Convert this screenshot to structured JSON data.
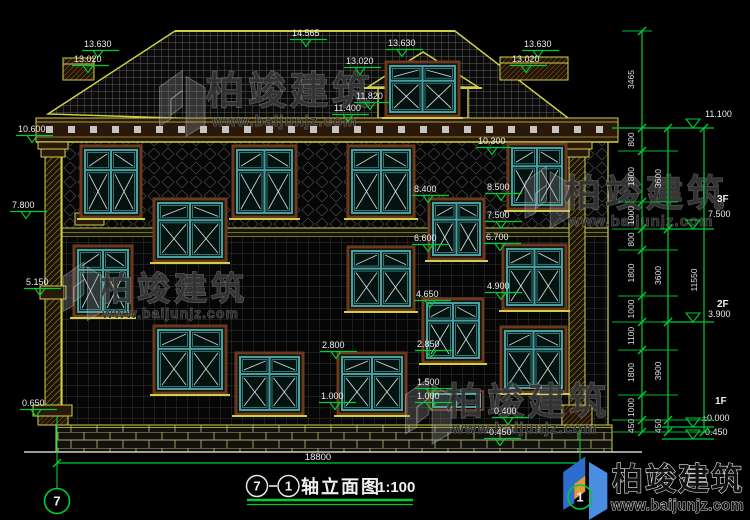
{
  "drawing": {
    "colors": {
      "background": "#000000",
      "cad_yellow": "#cfcf4a",
      "cad_green": "#00cc33",
      "window_teal": "#49a0a0",
      "window_teal_dark": "#2f7878",
      "trim_brown": "#6b3a1e",
      "band_brown": "#2a180a",
      "text_white": "#e8e8e8",
      "brand_blue": "#2e6cd0",
      "brand_blue2": "#4b8de2",
      "brand_orange": "#e09a3a"
    },
    "title": {
      "axis_start": "7",
      "axis_end": "1",
      "name": "轴立面图",
      "scale": "1:100"
    },
    "overall_width_dim": "18800",
    "axis_bubbles": [
      {
        "label": "7"
      },
      {
        "label": "1"
      }
    ],
    "brand": {
      "text": "柏竣建筑",
      "url": "www.baijunjz.com"
    },
    "watermarks": [
      {
        "text": "柏竣建筑",
        "url": "www.baijunjz.com",
        "icon_x": 150,
        "icon_y": 64,
        "icon_s": 0.95,
        "tx": 206,
        "ty": 104,
        "ts": 38,
        "ux": 212,
        "uy": 126,
        "us": 15
      },
      {
        "text": "柏竣建筑",
        "url": "www.baijunjz.com",
        "icon_x": 55,
        "icon_y": 256,
        "icon_s": 0.85,
        "tx": 100,
        "ty": 300,
        "ts": 33,
        "ux": 102,
        "uy": 318,
        "us": 14
      },
      {
        "text": "柏竣建筑",
        "url": "www.baijunjz.com",
        "icon_x": 516,
        "icon_y": 160,
        "icon_s": 0.9,
        "tx": 564,
        "ty": 206,
        "ts": 37,
        "ux": 568,
        "uy": 226,
        "us": 15
      },
      {
        "text": "柏竣建筑",
        "url": "www.baijunjz.com",
        "icon_x": 396,
        "icon_y": 372,
        "icon_s": 0.95,
        "tx": 446,
        "ty": 414,
        "ts": 37,
        "ux": 452,
        "uy": 433,
        "us": 15
      }
    ],
    "elevation_labels": [
      {
        "text": "13.630",
        "x": 84,
        "y": 39
      },
      {
        "text": "13.020",
        "x": 74,
        "y": 54
      },
      {
        "text": "14.565",
        "x": 292,
        "y": 28
      },
      {
        "text": "13.630",
        "x": 388,
        "y": 38
      },
      {
        "text": "13.020",
        "x": 346,
        "y": 56
      },
      {
        "text": "11.820",
        "x": 356,
        "y": 91
      },
      {
        "text": "11.400",
        "x": 334,
        "y": 103
      },
      {
        "text": "13.630",
        "x": 524,
        "y": 39
      },
      {
        "text": "13.020",
        "x": 512,
        "y": 54
      },
      {
        "text": "10.600",
        "x": 18,
        "y": 124
      },
      {
        "text": "10.300",
        "x": 478,
        "y": 136
      },
      {
        "text": "7.800",
        "x": 12,
        "y": 200
      },
      {
        "text": "5.150",
        "x": 26,
        "y": 277
      },
      {
        "text": "0.650",
        "x": 22,
        "y": 398
      },
      {
        "text": "8.400",
        "x": 414,
        "y": 184
      },
      {
        "text": "8.500",
        "x": 487,
        "y": 182
      },
      {
        "text": "7.500",
        "x": 487,
        "y": 210
      },
      {
        "text": "6.600",
        "x": 414,
        "y": 233
      },
      {
        "text": "6.700",
        "x": 486,
        "y": 232
      },
      {
        "text": "4.650",
        "x": 416,
        "y": 289
      },
      {
        "text": "4.900",
        "x": 487,
        "y": 281
      },
      {
        "text": "2.800",
        "x": 322,
        "y": 340
      },
      {
        "text": "2.850",
        "x": 417,
        "y": 339
      },
      {
        "text": "1.000",
        "x": 321,
        "y": 391
      },
      {
        "text": "1.500",
        "x": 417,
        "y": 377
      },
      {
        "text": "1.000",
        "x": 417,
        "y": 391
      },
      {
        "text": "0.400",
        "x": 494,
        "y": 406
      },
      {
        "text": "-0.450",
        "x": 486,
        "y": 427
      }
    ],
    "right_markers": [
      {
        "floor": "",
        "elev": "11.100",
        "fx": 0,
        "fy": 0,
        "ex": 705,
        "ey": 117,
        "line_y": 128,
        "x1": 612,
        "x2": 714
      },
      {
        "floor": "3F",
        "elev": "7.500",
        "fx": 717,
        "fy": 202,
        "ex": 708,
        "ey": 217,
        "line_y": 229,
        "x1": 662,
        "x2": 714
      },
      {
        "floor": "2F",
        "elev": "3.900",
        "fx": 717,
        "fy": 307,
        "ex": 708,
        "ey": 317,
        "line_y": 322,
        "x1": 662,
        "x2": 714
      },
      {
        "floor": "1F",
        "elev": "±0.000",
        "fx": 715,
        "fy": 404,
        "ex": 702,
        "ey": 421,
        "line_y": 427,
        "x1": 662,
        "x2": 714
      },
      {
        "floor": "",
        "elev": "-0.450",
        "fx": 0,
        "fy": 0,
        "ex": 702,
        "ey": 435,
        "line_y": 439,
        "x1": 662,
        "x2": 714
      }
    ],
    "dim_chains": [
      {
        "x": 642,
        "text_x": 634,
        "boundaries": [
          31,
          128,
          151,
          202,
          229,
          250,
          296,
          322,
          350,
          395,
          420,
          432
        ],
        "labels": [
          "3465",
          "800",
          "1800",
          "1000",
          "800",
          "1800",
          "1000",
          "1100",
          "1800",
          "1000",
          "450"
        ]
      },
      {
        "x": 668,
        "text_x": 661,
        "boundaries": [
          128,
          229,
          322,
          420,
          432
        ],
        "labels": [
          "3600",
          "3600",
          "3900",
          "450"
        ]
      },
      {
        "x": 704,
        "text_x": 697,
        "boundaries": [
          128,
          432
        ],
        "labels": [
          "11550"
        ]
      }
    ],
    "witness_lines": [
      [
        622,
        31,
        652
      ],
      [
        612,
        128,
        714
      ],
      [
        618,
        151,
        678
      ],
      [
        618,
        202,
        678
      ],
      [
        612,
        229,
        678
      ],
      [
        618,
        250,
        678
      ],
      [
        618,
        296,
        678
      ],
      [
        612,
        322,
        678
      ],
      [
        618,
        350,
        678
      ],
      [
        618,
        395,
        678
      ],
      [
        612,
        420,
        714
      ],
      [
        612,
        432,
        714
      ]
    ],
    "windows": [
      [
        390,
        66,
        65,
        46,
        "std"
      ],
      [
        85,
        150,
        52,
        63,
        "std"
      ],
      [
        237,
        150,
        55,
        63,
        "std"
      ],
      [
        352,
        150,
        58,
        63,
        "std"
      ],
      [
        512,
        148,
        50,
        57,
        "std"
      ],
      [
        158,
        203,
        64,
        54,
        "std"
      ],
      [
        433,
        203,
        47,
        52,
        "std"
      ],
      [
        78,
        250,
        50,
        62,
        "std"
      ],
      [
        352,
        251,
        58,
        55,
        "std"
      ],
      [
        507,
        249,
        55,
        56,
        "std"
      ],
      [
        158,
        330,
        64,
        59,
        "std"
      ],
      [
        505,
        331,
        57,
        57,
        "std"
      ],
      [
        427,
        303,
        52,
        55,
        "std"
      ],
      [
        240,
        357,
        59,
        53,
        "std"
      ],
      [
        342,
        357,
        60,
        53,
        "std"
      ],
      [
        433,
        394,
        47,
        13,
        "small"
      ]
    ],
    "axis_lines": [
      [
        57,
        416,
        489
      ],
      [
        580,
        430,
        486
      ]
    ],
    "bottom_dim_line": {
      "y": 463,
      "x1": 57,
      "x2": 580
    }
  }
}
